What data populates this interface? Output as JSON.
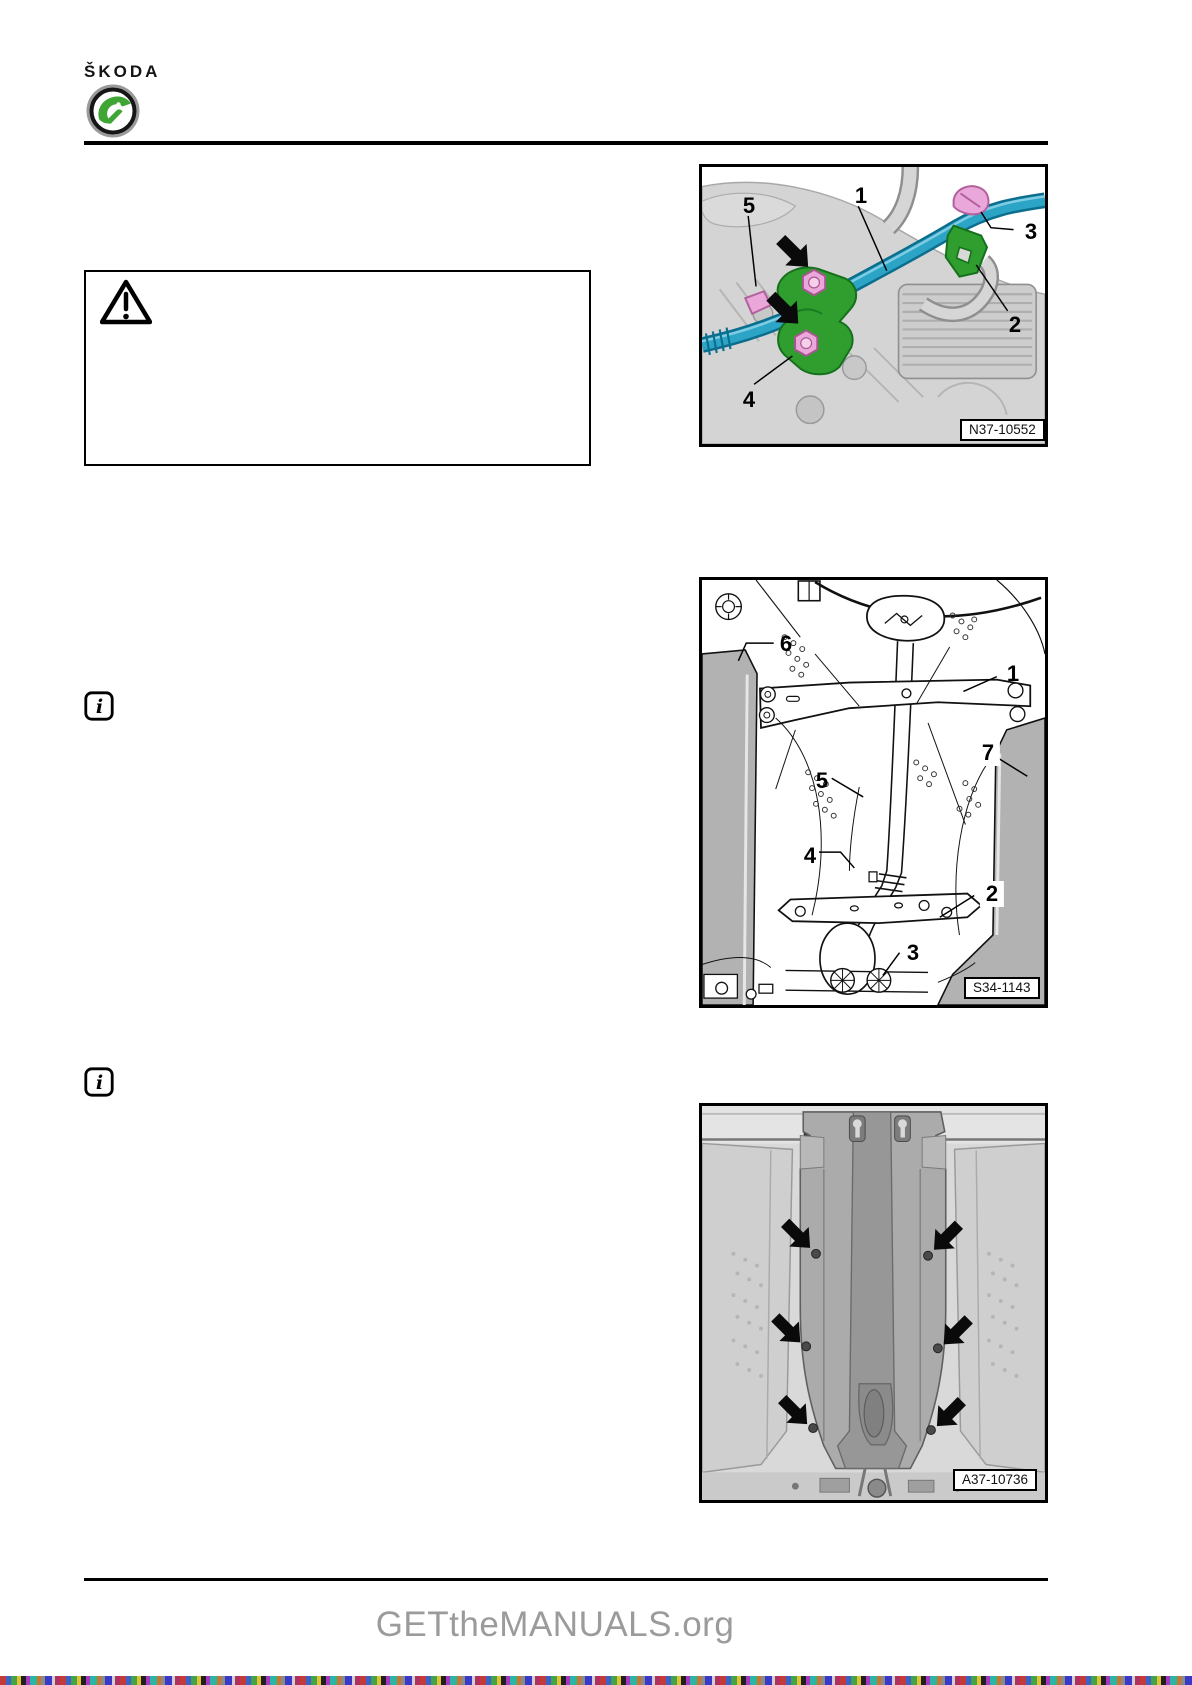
{
  "page": {
    "background": "#ffffff"
  },
  "header": {
    "brand": "ŠKODA",
    "logo": {
      "icon": "skoda-logo-icon",
      "green": "#3fa535",
      "ring_color": "#1a1a1a"
    }
  },
  "warning_box": {
    "icon": "warning-triangle-icon"
  },
  "info_notes": [
    {
      "icon": "info-icon"
    },
    {
      "icon": "info-icon"
    }
  ],
  "figures": [
    {
      "name": "coolant-pipe-on-gearbox",
      "ref": "N37-10552",
      "colors": {
        "pipe_teal": "#2ba4c6",
        "bracket_green": "#2f9e2f",
        "bolt_pink": "#e9a8d9"
      },
      "callouts": [
        {
          "label": "5"
        },
        {
          "label": "1"
        },
        {
          "label": "3"
        },
        {
          "label": "2"
        },
        {
          "label": "4"
        }
      ]
    },
    {
      "name": "underbody-cross-brace",
      "ref": "S34-1143",
      "callouts": [
        {
          "label": "6"
        },
        {
          "label": "1"
        },
        {
          "label": "7"
        },
        {
          "label": "5"
        },
        {
          "label": "4"
        },
        {
          "label": "2"
        },
        {
          "label": "3"
        }
      ]
    },
    {
      "name": "underbody-insulation-cover",
      "ref": "A37-10736",
      "callouts": []
    }
  ],
  "footer": {
    "site": "GETtheMANUALS.org",
    "text_color": "#9b9b9b"
  }
}
